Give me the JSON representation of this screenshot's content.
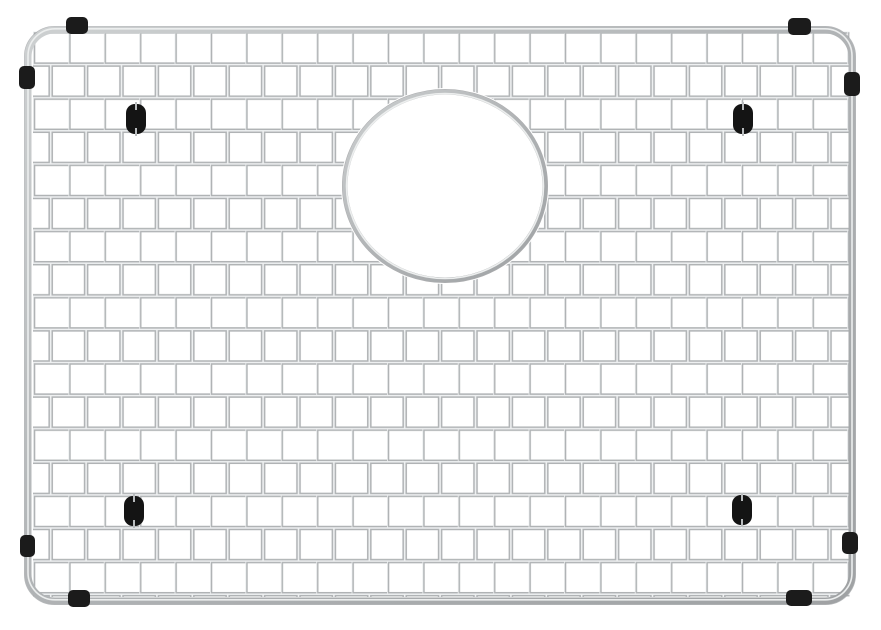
{
  "image": {
    "type": "product-photo",
    "subject": "stainless-steel-sink-bottom-grid",
    "background_color": "#ffffff"
  },
  "grid": {
    "columns": 23,
    "rows": 17,
    "x": 33,
    "y": 31.5,
    "cell_width": 35.4,
    "cell_height": 33.1,
    "stagger": true,
    "wire_color": "#b0b3b5",
    "wire_highlight": "#eef0f1",
    "wire_width": 4.6,
    "highlight_width": 1.6,
    "area_width": 816.5,
    "area_height": 565.5
  },
  "frame": {
    "x": 28,
    "y": 30,
    "width": 824,
    "height": 571,
    "corner_radius": 27,
    "stroke_width": 7,
    "gradient_light": "#cdd0d1",
    "gradient_dark": "#9fa2a4",
    "highlight": "#eceeee",
    "edge_dark": "#9a9da0"
  },
  "drain_opening": {
    "cx": 445,
    "cy": 186,
    "rx": 100,
    "ry": 94,
    "cut_rx": 104,
    "cut_ry": 98,
    "ring_width": 5,
    "ring_highlight": "#eceeee",
    "ring_edge": "#97999b",
    "fill": "#ffffff"
  },
  "bumpers": {
    "color": "#1b1b1b",
    "corner_radius": 5,
    "items": [
      {
        "name": "bumper-top-left-top",
        "x": 66,
        "y": 17,
        "w": 22,
        "h": 17
      },
      {
        "name": "bumper-top-left-side",
        "x": 19,
        "y": 66,
        "w": 16,
        "h": 23
      },
      {
        "name": "bumper-top-right-top",
        "x": 788,
        "y": 18,
        "w": 23,
        "h": 17
      },
      {
        "name": "bumper-top-right-side",
        "x": 844,
        "y": 72,
        "w": 16,
        "h": 24
      },
      {
        "name": "bumper-bottom-left-side",
        "x": 20,
        "y": 535,
        "w": 15,
        "h": 22
      },
      {
        "name": "bumper-bottom-left-bottom",
        "x": 68,
        "y": 590,
        "w": 22,
        "h": 17
      },
      {
        "name": "bumper-bottom-right-bottom",
        "x": 786,
        "y": 590,
        "w": 26,
        "h": 16
      },
      {
        "name": "bumper-bottom-right-side",
        "x": 842,
        "y": 532,
        "w": 16,
        "h": 22
      }
    ]
  },
  "feet": {
    "color": "#141414",
    "width": 20,
    "height": 30,
    "corner_radius": 9,
    "notch_color": "#b9bcbe",
    "items": [
      {
        "name": "foot-top-left",
        "cx": 136,
        "cy": 119
      },
      {
        "name": "foot-top-right",
        "cx": 743,
        "cy": 119
      },
      {
        "name": "foot-bottom-left",
        "cx": 134,
        "cy": 511
      },
      {
        "name": "foot-bottom-right",
        "cx": 742,
        "cy": 510
      }
    ]
  }
}
